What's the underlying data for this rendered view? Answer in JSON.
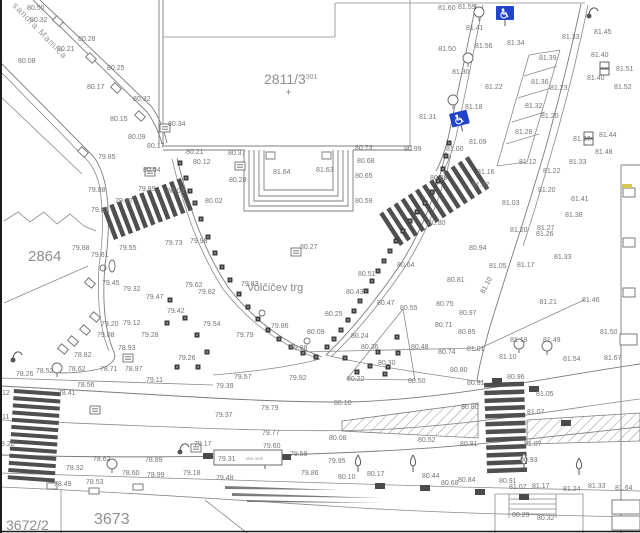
{
  "map": {
    "place_label": "Volčičev trg",
    "street_label": "sandra Mamiča",
    "eko_box": {
      "value": "79.31",
      "note": "eko otok"
    },
    "colors": {
      "label_gray": "#757575",
      "line_gray": "#7c7c7c",
      "stripe_dark": "#4f4f4f",
      "handicap_blue": "#2244cc",
      "highlight_yellow": "#d9c84f"
    },
    "parcels": [
      {
        "text": "2811/3",
        "sup": "301",
        "x": 264,
        "y": 84,
        "size": 14
      },
      {
        "text": "2864",
        "x": 28,
        "y": 261,
        "size": 15
      },
      {
        "text": "3673",
        "x": 94,
        "y": 524,
        "size": 16
      },
      {
        "text": "3672/2",
        "x": 6,
        "y": 530,
        "size": 14
      }
    ],
    "spot_heights": [
      [
        27,
        10,
        "80.50"
      ],
      [
        30,
        22,
        "80.32"
      ],
      [
        78,
        41,
        "80.28"
      ],
      [
        57,
        51,
        "80.21"
      ],
      [
        18,
        63,
        "80.08"
      ],
      [
        107,
        70,
        "80.25"
      ],
      [
        87,
        89,
        "80.17"
      ],
      [
        133,
        101,
        "80.32"
      ],
      [
        110,
        121,
        "80.15"
      ],
      [
        168,
        126,
        "80.34"
      ],
      [
        128,
        139,
        "80.09"
      ],
      [
        147,
        148,
        "80.17"
      ],
      [
        186,
        154,
        "80.21"
      ],
      [
        228,
        155,
        "80.37"
      ],
      [
        193,
        164,
        "80.12"
      ],
      [
        98,
        159,
        "79.85"
      ],
      [
        143,
        172,
        "80.04"
      ],
      [
        229,
        182,
        "80.28"
      ],
      [
        167,
        193,
        "80.03"
      ],
      [
        138,
        191,
        "79.89"
      ],
      [
        115,
        203,
        "79.72"
      ],
      [
        91,
        212,
        "79.87"
      ],
      [
        205,
        203,
        "80.02"
      ],
      [
        88,
        192,
        "79.88"
      ],
      [
        355,
        150,
        "80.73"
      ],
      [
        404,
        151,
        "80.99"
      ],
      [
        357,
        163,
        "80.68"
      ],
      [
        273,
        174,
        "81.64"
      ],
      [
        316,
        172,
        "81.63"
      ],
      [
        355,
        178,
        "80.65"
      ],
      [
        355,
        203,
        "80.59"
      ],
      [
        430,
        180,
        "80.89"
      ],
      [
        428,
        225,
        "80.80"
      ],
      [
        438,
        10,
        "81.60"
      ],
      [
        458,
        9,
        "81.59"
      ],
      [
        466,
        30,
        "81.41"
      ],
      [
        507,
        45,
        "81.34"
      ],
      [
        436,
        51,
        "·81.50"
      ],
      [
        475,
        48,
        "81.56"
      ],
      [
        452,
        74,
        "81.30"
      ],
      [
        485,
        89,
        "81.22"
      ],
      [
        465,
        109,
        "81.18"
      ],
      [
        419,
        119,
        "81.31"
      ],
      [
        469,
        144,
        "81.09"
      ],
      [
        446,
        151,
        "81.00"
      ],
      [
        477,
        174,
        "81.16"
      ],
      [
        562,
        39,
        "81.33"
      ],
      [
        594,
        34,
        "81.45"
      ],
      [
        539,
        60,
        "81.39"
      ],
      [
        591,
        57,
        "81.40"
      ],
      [
        587,
        80,
        "81.40"
      ],
      [
        616,
        71,
        "81.51"
      ],
      [
        614,
        89,
        "81.52"
      ],
      [
        531,
        84,
        "81.36"
      ],
      [
        550,
        90,
        "81.23"
      ],
      [
        525,
        108,
        "81.32"
      ],
      [
        541,
        118,
        "81.20"
      ],
      [
        515,
        134,
        "81.28"
      ],
      [
        599,
        137,
        "81.44"
      ],
      [
        573,
        141,
        "81.37"
      ],
      [
        595,
        154,
        "81.48"
      ],
      [
        519,
        164,
        "81.12"
      ],
      [
        543,
        173,
        "81.22"
      ],
      [
        569,
        164,
        "81.33"
      ],
      [
        472,
        187,
        "81.07"
      ],
      [
        502,
        205,
        "81.03"
      ],
      [
        538,
        192,
        "81.20"
      ],
      [
        571,
        201,
        "81.41"
      ],
      [
        565,
        217,
        "81.38"
      ],
      [
        537,
        230,
        "81.27"
      ],
      [
        536,
        236,
        "81.26"
      ],
      [
        510,
        232,
        "81.20"
      ],
      [
        554,
        259,
        "81.33"
      ],
      [
        469,
        250,
        "80.94"
      ],
      [
        489,
        268,
        "81.05"
      ],
      [
        517,
        267,
        "81.17"
      ],
      [
        447,
        282,
        "80.81"
      ],
      [
        436,
        306,
        "80.75"
      ],
      [
        459,
        315,
        "80.97"
      ],
      [
        435,
        327,
        "80.71"
      ],
      [
        458,
        334,
        "80.85"
      ],
      [
        537,
        304,
        "·81.21"
      ],
      [
        582,
        302,
        "81.46"
      ],
      [
        510,
        342,
        "81.18"
      ],
      [
        543,
        342,
        "81.49"
      ],
      [
        600,
        334,
        "81.50"
      ],
      [
        467,
        351,
        "81.01"
      ],
      [
        438,
        354,
        "80.74"
      ],
      [
        450,
        372,
        "80.80"
      ],
      [
        507,
        379,
        "80.96"
      ],
      [
        467,
        385,
        "80.81"
      ],
      [
        536,
        396,
        "81.05"
      ],
      [
        461,
        409,
        "80.80"
      ],
      [
        527,
        414,
        "81.07"
      ],
      [
        418,
        442,
        "80.52"
      ],
      [
        460,
        446,
        "80.81"
      ],
      [
        524,
        446,
        "81.07"
      ],
      [
        520,
        462,
        "80.93"
      ],
      [
        441,
        485,
        "80.68"
      ],
      [
        458,
        482,
        "80.84"
      ],
      [
        499,
        483,
        "80.91"
      ],
      [
        509,
        489,
        "81.07"
      ],
      [
        532,
        488,
        "81.17"
      ],
      [
        563,
        491,
        "81.24"
      ],
      [
        588,
        488,
        "81.33"
      ],
      [
        615,
        490,
        "81.64"
      ],
      [
        512,
        517,
        "80.29"
      ],
      [
        537,
        520,
        "80.32"
      ],
      [
        422,
        478,
        "80.44"
      ],
      [
        499,
        359,
        "81.10"
      ],
      [
        563,
        361,
        "81.54"
      ],
      [
        604,
        360,
        "81.67"
      ],
      [
        234,
        379,
        "79.57"
      ],
      [
        289,
        380,
        "79.92"
      ],
      [
        216,
        388,
        "79.39"
      ],
      [
        261,
        410,
        "79.79"
      ],
      [
        215,
        417,
        "79.37"
      ],
      [
        334,
        405,
        "80.10"
      ],
      [
        262,
        435,
        "79.77"
      ],
      [
        329,
        440,
        "80.08"
      ],
      [
        263,
        448,
        "79.60"
      ],
      [
        290,
        456,
        "79.58"
      ],
      [
        328,
        463,
        "79.95"
      ],
      [
        301,
        475,
        "79.86"
      ],
      [
        338,
        479,
        "80.10"
      ],
      [
        367,
        476,
        "80.17"
      ],
      [
        216,
        480,
        "79.48"
      ],
      [
        347,
        381,
        "80.22"
      ],
      [
        378,
        365,
        "80.30"
      ],
      [
        408,
        383,
        "80.50"
      ],
      [
        400,
        310,
        "80.55"
      ],
      [
        361,
        349,
        "80.36"
      ],
      [
        411,
        349,
        "80.48"
      ],
      [
        351,
        338,
        "80.24"
      ],
      [
        325,
        316,
        "80.25"
      ],
      [
        307,
        334,
        "80.09"
      ],
      [
        271,
        328,
        "79.86"
      ],
      [
        236,
        337,
        "79.79"
      ],
      [
        290,
        350,
        "79.88"
      ],
      [
        300,
        249,
        "80.27"
      ],
      [
        241,
        286,
        "79.83"
      ],
      [
        198,
        294,
        "79.82"
      ],
      [
        358,
        276,
        "80.51"
      ],
      [
        397,
        267,
        "80.64"
      ],
      [
        346,
        294,
        "80.43"
      ],
      [
        377,
        305,
        "80.47"
      ],
      [
        16,
        376,
        "78.26"
      ],
      [
        36,
        373,
        "78.52"
      ],
      [
        68,
        371,
        "78.62"
      ],
      [
        100,
        371,
        "78.71"
      ],
      [
        125,
        371,
        "78.97"
      ],
      [
        178,
        360,
        "79.26"
      ],
      [
        77,
        387,
        "78.56"
      ],
      [
        146,
        382,
        "79.11"
      ],
      [
        58,
        395,
        "78.41"
      ],
      [
        194,
        446,
        "79.17"
      ],
      [
        93,
        461,
        "78.62"
      ],
      [
        145,
        462,
        "78.89"
      ],
      [
        66,
        470,
        "78.32"
      ],
      [
        122,
        475,
        "78.60"
      ],
      [
        147,
        477,
        "78.99"
      ],
      [
        183,
        475,
        "79.18"
      ],
      [
        54,
        486,
        "78.49"
      ],
      [
        86,
        484,
        "78.53"
      ],
      [
        2,
        395,
        "12"
      ],
      [
        2,
        419,
        "11"
      ],
      [
        1,
        446,
        "8.20"
      ],
      [
        74,
        357,
        "78.82"
      ],
      [
        118,
        350,
        "78.93"
      ],
      [
        72,
        250,
        "79.88"
      ],
      [
        91,
        257,
        "79.61"
      ],
      [
        119,
        250,
        "79.55"
      ],
      [
        165,
        245,
        "79.73"
      ],
      [
        190,
        243,
        "79.98"
      ],
      [
        102,
        285,
        "79.45"
      ],
      [
        123,
        291,
        "79.32"
      ],
      [
        146,
        299,
        "79.47"
      ],
      [
        185,
        287,
        "79.62"
      ],
      [
        167,
        313,
        "79.42"
      ],
      [
        203,
        326,
        "79.54"
      ],
      [
        101,
        326,
        "79.20"
      ],
      [
        123,
        325,
        "79.12"
      ],
      [
        97,
        337,
        "79.08"
      ],
      [
        141,
        337,
        "79.28"
      ]
    ],
    "rotated_labels": [
      {
        "x": 484,
        "y": 294,
        "t": "81.10",
        "r": -62
      }
    ],
    "crosswalks": [
      {
        "x": 114,
        "y": 240,
        "rot": -21,
        "count": 11,
        "step": 8,
        "w": 4.5,
        "h": 34,
        "dir": "v"
      },
      {
        "x": 400,
        "y": 246,
        "rot": -33,
        "count": 13,
        "step": 8.5,
        "w": 4.5,
        "h": 38,
        "dir": "v"
      },
      {
        "x": 14,
        "y": 389,
        "rot": 4,
        "count": 13,
        "step": 7.2,
        "w": 47,
        "h": 4,
        "dir": "h"
      },
      {
        "x": 484,
        "y": 383,
        "rot": -2,
        "count": 12,
        "step": 7.8,
        "w": 40,
        "h": 4.5,
        "dir": "h"
      }
    ],
    "hatch_areas": [
      "342,421 478,403 478,438 342,431",
      "527,420 640,413 640,441 527,444"
    ],
    "icons": {
      "handicap_signs": [
        {
          "x": 496,
          "y": 6,
          "r": 0
        },
        {
          "x": 449,
          "y": 114,
          "r": -14
        }
      ],
      "markers": [
        [
          180,
          163
        ],
        [
          186,
          178
        ],
        [
          190,
          191
        ],
        [
          195,
          203
        ],
        [
          201,
          219
        ],
        [
          208,
          237
        ],
        [
          215,
          253
        ],
        [
          222,
          267
        ],
        [
          230,
          280
        ],
        [
          239,
          294
        ],
        [
          248,
          307
        ],
        [
          258,
          319
        ],
        [
          268,
          330
        ],
        [
          279,
          339
        ],
        [
          291,
          347
        ],
        [
          303,
          353
        ],
        [
          316,
          357
        ],
        [
          449,
          143
        ],
        [
          446,
          156
        ],
        [
          443,
          169
        ],
        [
          438,
          181
        ],
        [
          432,
          192
        ],
        [
          425,
          203
        ],
        [
          417,
          212
        ],
        [
          410,
          221
        ],
        [
          403,
          231
        ],
        [
          396,
          241
        ],
        [
          390,
          251
        ],
        [
          384,
          261
        ],
        [
          378,
          271
        ],
        [
          372,
          281
        ],
        [
          366,
          291
        ],
        [
          360,
          301
        ],
        [
          354,
          311
        ],
        [
          348,
          320
        ],
        [
          341,
          330
        ],
        [
          334,
          339
        ],
        [
          327,
          347
        ],
        [
          397,
          337
        ],
        [
          378,
          352
        ],
        [
          398,
          353
        ],
        [
          370,
          366
        ],
        [
          388,
          367
        ],
        [
          345,
          358
        ],
        [
          357,
          372
        ],
        [
          385,
          374
        ],
        [
          170,
          300
        ],
        [
          185,
          318
        ],
        [
          167,
          323
        ],
        [
          197,
          335
        ],
        [
          207,
          352
        ],
        [
          177,
          367
        ],
        [
          198,
          367
        ]
      ],
      "manholes": [
        [
          165,
          128
        ],
        [
          150,
          172
        ],
        [
          240,
          166
        ],
        [
          296,
          252
        ],
        [
          128,
          358
        ],
        [
          196,
          448
        ],
        [
          95,
          410
        ]
      ],
      "kerb_boxes": [
        [
          58,
          21,
          43
        ],
        [
          91,
          58,
          43
        ],
        [
          116,
          88,
          43
        ],
        [
          140,
          116,
          43
        ],
        [
          83,
          152,
          43
        ],
        [
          90,
          283,
          40
        ],
        [
          95,
          317,
          40
        ],
        [
          85,
          330,
          40
        ],
        [
          73,
          341,
          40
        ],
        [
          63,
          349,
          40
        ]
      ],
      "grates_dark": [
        [
          380,
          486
        ],
        [
          425,
          488
        ],
        [
          480,
          492
        ],
        [
          524,
          497
        ],
        [
          566,
          423
        ],
        [
          534,
          389
        ],
        [
          286,
          457
        ],
        [
          208,
          456
        ],
        [
          497,
          381
        ]
      ],
      "grates_white": [
        [
          52,
          486
        ],
        [
          94,
          491
        ],
        [
          138,
          487
        ]
      ],
      "poles": [
        [
          262,
          313
        ],
        [
          307,
          341
        ],
        [
          103,
          268
        ]
      ],
      "pole_ellipses": [
        [
          112,
          266
        ]
      ],
      "lamps": [
        [
          13,
          360
        ],
        [
          180,
          452
        ],
        [
          589,
          16
        ]
      ],
      "trees_round": [
        [
          479,
          12
        ],
        [
          468,
          58
        ],
        [
          453,
          100
        ],
        [
          57,
          368
        ],
        [
          112,
          464
        ],
        [
          519,
          344
        ],
        [
          547,
          346
        ]
      ],
      "trees_conifer": [
        [
          265,
          462
        ],
        [
          358,
          465
        ],
        [
          413,
          465
        ],
        [
          524,
          463
        ],
        [
          579,
          468
        ]
      ],
      "meters": [
        [
          600,
          62
        ],
        [
          584,
          132
        ]
      ],
      "edge_boxes": [
        [
          623,
          188,
          12,
          9
        ],
        [
          623,
          238,
          12,
          9
        ],
        [
          623,
          288,
          12,
          9
        ],
        [
          620,
          334,
          17,
          11
        ],
        [
          612,
          500,
          28,
          14
        ],
        [
          612,
          516,
          28,
          14
        ]
      ],
      "yellow_ticks": [
        [
          622,
          184,
          10,
          4
        ]
      ]
    }
  }
}
